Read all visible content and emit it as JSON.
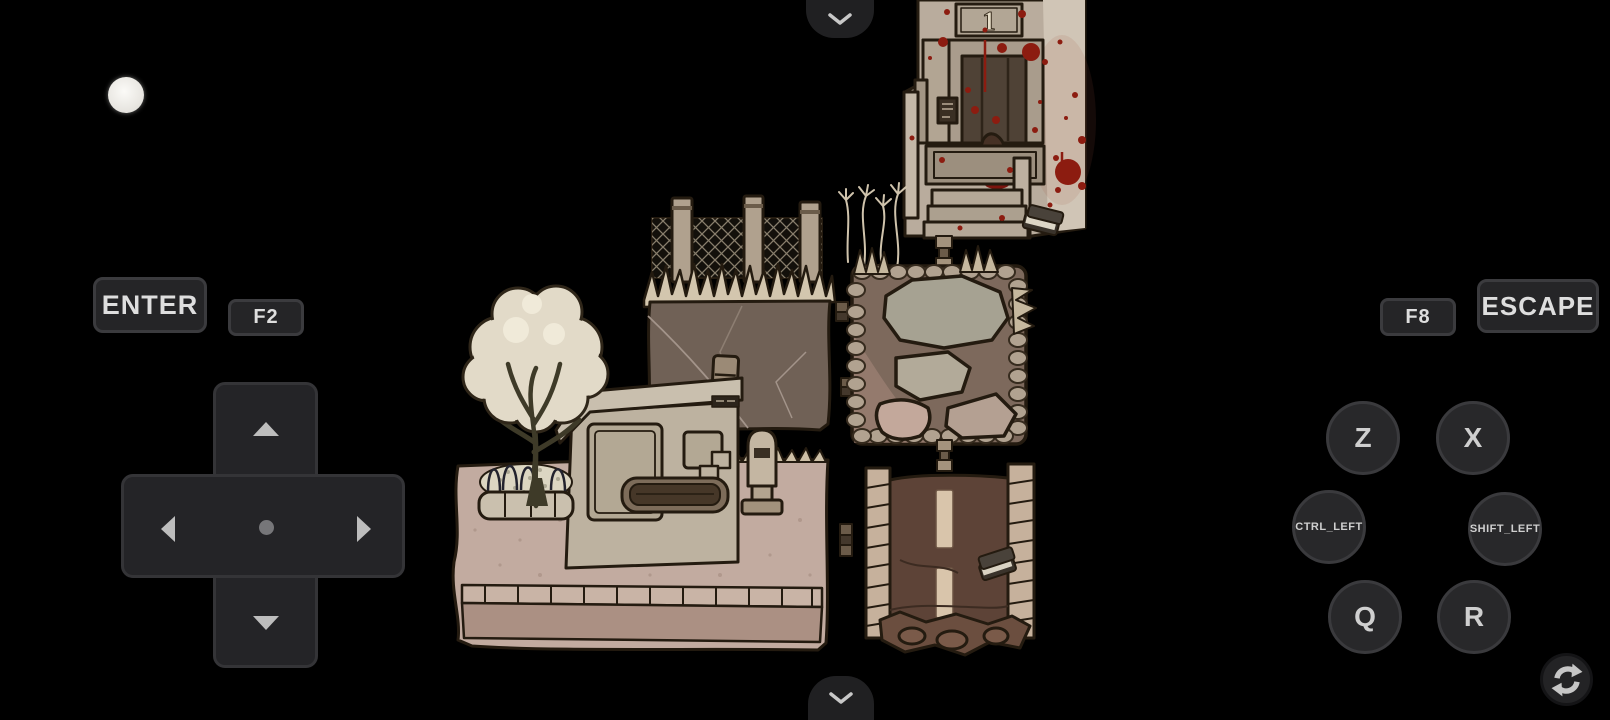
{
  "app": {
    "kind": "game-emulator-touch-overlay",
    "background_color": "#000000"
  },
  "controls": {
    "enter": "ENTER",
    "f2": "F2",
    "f8": "F8",
    "escape": "ESCAPE",
    "z": "Z",
    "x": "X",
    "ctrl": "CTRL_LEFT",
    "shift": "SHIFT_LEFT",
    "q": "Q",
    "r": "R"
  },
  "icons": {
    "top_handle": "chevron-down",
    "bottom_handle": "chevron-down",
    "rotate": "rotate-screen-circular-arrows",
    "menu_ball": "floating-menu-ball",
    "dpad": "up-down-left-right-arrows"
  },
  "game": {
    "building_number": "1",
    "scene_description": "dark hand-drawn map tiles: bloody building entrance no.1, lattice fence wall, stone plaza, road with dropped book, sidewalk with tree planter, kiosk bus stop, bench and hydrant"
  },
  "colors": {
    "button_bg": "#252527",
    "button_border": "#3b3b3e",
    "button_text": "#dedede",
    "dpad_bg": "#242427",
    "arrow_gray": "#bdbdbd",
    "blood_red": "#8c1c10",
    "building_wall": "#b9ac9d",
    "fence_wall": "#706156",
    "plaza_ground": "#7d695c",
    "road_asphalt": "#5d4337",
    "sidewalk": "#c2aba0",
    "tree_canopy": "#e2dac8",
    "outline_ink": "#241b10"
  }
}
